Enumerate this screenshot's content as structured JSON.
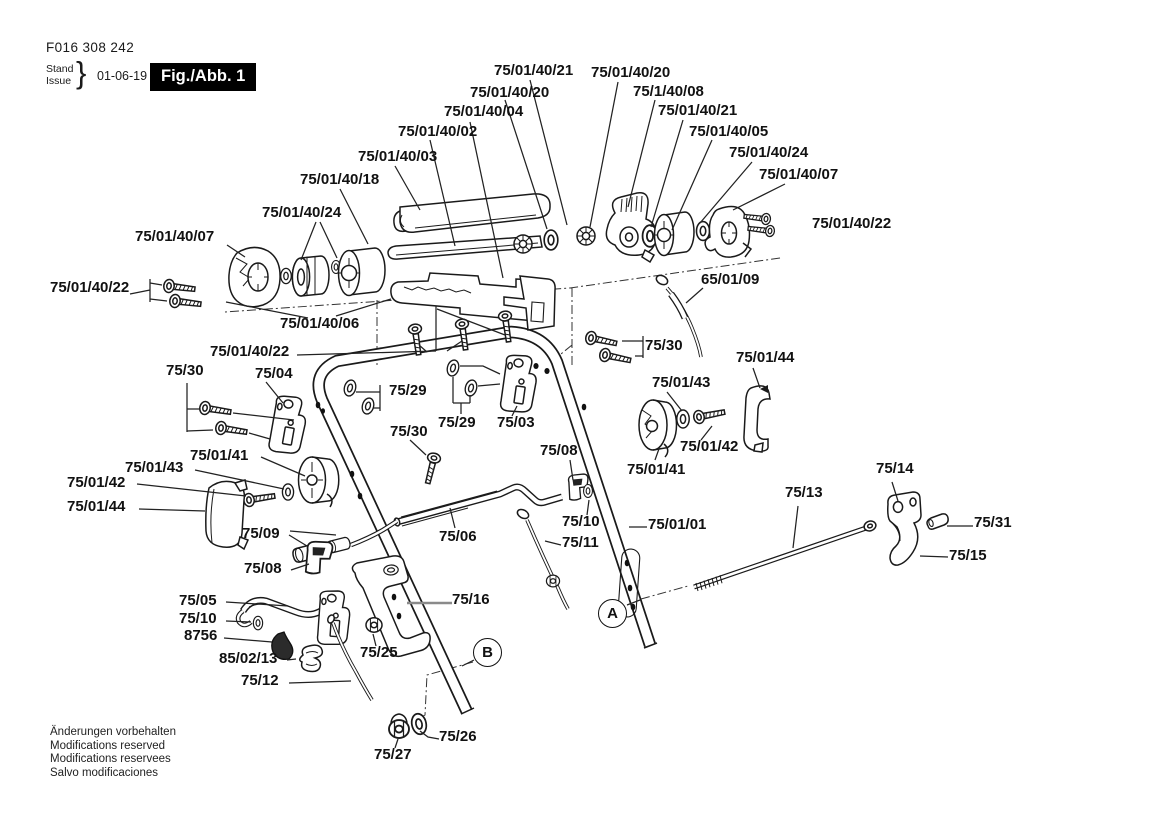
{
  "header": {
    "document_number": "F016 308 242",
    "stand_label": "Stand",
    "issue_label": "Issue",
    "brace": "}",
    "issue_date": "01-06-19",
    "figure_label": "Fig./Abb. 1"
  },
  "figure": {
    "part_labels": [
      {
        "text": "75/01/40/21",
        "x": 494,
        "y": 62
      },
      {
        "text": "75/01/40/20",
        "x": 591,
        "y": 64
      },
      {
        "text": "75/01/40/20",
        "x": 470,
        "y": 84
      },
      {
        "text": "75/1/40/08",
        "x": 633,
        "y": 83
      },
      {
        "text": "75/01/40/04",
        "x": 444,
        "y": 103
      },
      {
        "text": "75/01/40/21",
        "x": 658,
        "y": 102
      },
      {
        "text": "75/01/40/02",
        "x": 398,
        "y": 123
      },
      {
        "text": "75/01/40/05",
        "x": 689,
        "y": 123
      },
      {
        "text": "75/01/40/03",
        "x": 358,
        "y": 148
      },
      {
        "text": "75/01/40/24",
        "x": 729,
        "y": 144
      },
      {
        "text": "75/01/40/18",
        "x": 300,
        "y": 171
      },
      {
        "text": "75/01/40/07",
        "x": 759,
        "y": 166
      },
      {
        "text": "75/01/40/24",
        "x": 262,
        "y": 204
      },
      {
        "text": "75/01/40/07",
        "x": 135,
        "y": 228
      },
      {
        "text": "75/01/40/22",
        "x": 50,
        "y": 279
      },
      {
        "text": "75/01/40/22",
        "x": 812,
        "y": 215
      },
      {
        "text": "65/01/09",
        "x": 701,
        "y": 271
      },
      {
        "text": "75/01/40/06",
        "x": 280,
        "y": 315
      },
      {
        "text": "75/01/40/22",
        "x": 210,
        "y": 343
      },
      {
        "text": "75/30",
        "x": 166,
        "y": 362
      },
      {
        "text": "75/04",
        "x": 255,
        "y": 365
      },
      {
        "text": "75/29",
        "x": 389,
        "y": 382
      },
      {
        "text": "75/30",
        "x": 645,
        "y": 337
      },
      {
        "text": "75/01/44",
        "x": 736,
        "y": 349
      },
      {
        "text": "75/29",
        "x": 438,
        "y": 414
      },
      {
        "text": "75/03",
        "x": 497,
        "y": 414
      },
      {
        "text": "75/01/43",
        "x": 652,
        "y": 374
      },
      {
        "text": "75/30",
        "x": 390,
        "y": 423
      },
      {
        "text": "75/08",
        "x": 540,
        "y": 442
      },
      {
        "text": "75/01/42",
        "x": 680,
        "y": 438
      },
      {
        "text": "75/01/41",
        "x": 190,
        "y": 447
      },
      {
        "text": "75/01/41",
        "x": 627,
        "y": 461
      },
      {
        "text": "75/14",
        "x": 876,
        "y": 460
      },
      {
        "text": "75/01/43",
        "x": 125,
        "y": 459
      },
      {
        "text": "75/13",
        "x": 785,
        "y": 484
      },
      {
        "text": "75/01/42",
        "x": 67,
        "y": 474
      },
      {
        "text": "75/01/44",
        "x": 67,
        "y": 498
      },
      {
        "text": "75/10",
        "x": 562,
        "y": 513
      },
      {
        "text": "75/01/01",
        "x": 648,
        "y": 516
      },
      {
        "text": "75/31",
        "x": 974,
        "y": 514
      },
      {
        "text": "75/09",
        "x": 242,
        "y": 525
      },
      {
        "text": "75/11",
        "x": 562,
        "y": 534
      },
      {
        "text": "75/06",
        "x": 439,
        "y": 528
      },
      {
        "text": "75/15",
        "x": 949,
        "y": 547
      },
      {
        "text": "75/08",
        "x": 244,
        "y": 560
      },
      {
        "text": "75/05",
        "x": 179,
        "y": 592
      },
      {
        "text": "75/16",
        "x": 452,
        "y": 591
      },
      {
        "text": "75/10",
        "x": 179,
        "y": 610
      },
      {
        "text": "8756",
        "x": 184,
        "y": 627
      },
      {
        "text": "85/02/13",
        "x": 219,
        "y": 650
      },
      {
        "text": "75/25",
        "x": 360,
        "y": 644
      },
      {
        "text": "75/12",
        "x": 241,
        "y": 672
      },
      {
        "text": "75/26",
        "x": 439,
        "y": 728
      },
      {
        "text": "75/27",
        "x": 374,
        "y": 746
      }
    ],
    "view_markers": [
      {
        "text": "A",
        "x": 612,
        "y": 613
      },
      {
        "text": "B",
        "x": 487,
        "y": 652
      }
    ]
  },
  "footer": {
    "lines": [
      "Änderungen vorbehalten",
      "Modifications reserved",
      "Modifications reservees",
      "Salvo modificaciones"
    ]
  }
}
